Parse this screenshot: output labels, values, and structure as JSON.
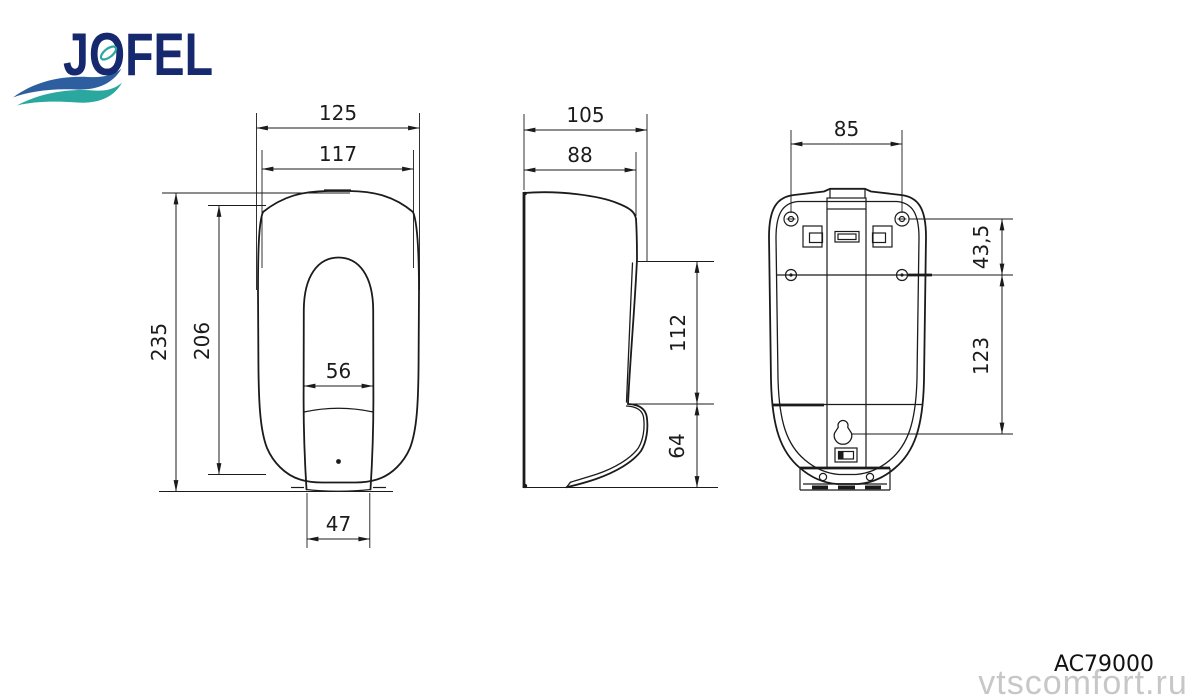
{
  "brand": {
    "name": "JOFEL"
  },
  "footer": {
    "product_code": "AC79000",
    "watermark": "vtscomfort.ru"
  },
  "colors": {
    "line": "#1b1b1b",
    "logo_navy": "#16286e",
    "logo_wave_blue": "#2d5fa0",
    "logo_wave_teal": "#2aa79e",
    "watermark_gray": "#c7c7c7",
    "background": "#ffffff"
  },
  "views": {
    "front": {
      "dims": {
        "overall_width": "125",
        "body_width": "117",
        "overall_height": "235",
        "body_height": "206",
        "window_width": "56",
        "base_width": "47"
      }
    },
    "side": {
      "dims": {
        "overall_depth": "105",
        "body_depth": "88",
        "front_panel_height": "112",
        "lever_height": "64"
      }
    },
    "back": {
      "dims": {
        "mount_hole_spacing": "85",
        "mount_hole_row_offset": "43,5",
        "keyhole_offset": "123"
      }
    }
  }
}
